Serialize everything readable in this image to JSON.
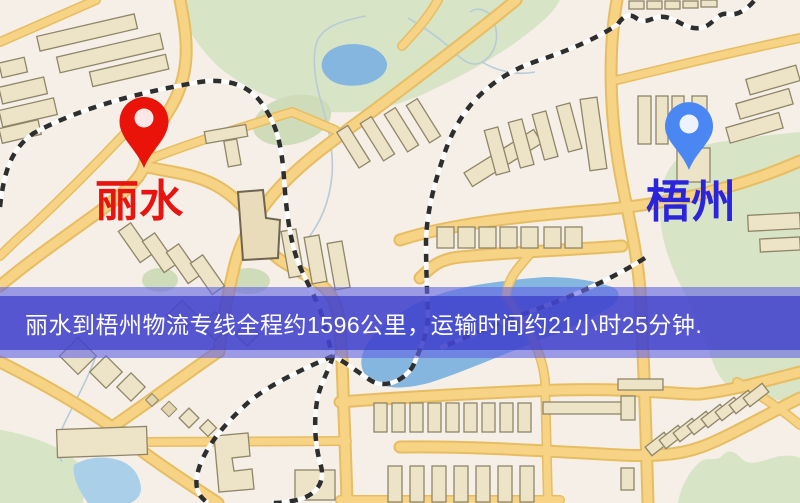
{
  "banner": {
    "text": "丽水到梧州物流专线全程约1596公里，运输时间约21小时25分钟.",
    "text_color": "#ffffff",
    "inner_band_color": "rgba(58,60,200,0.72)",
    "outer_band_color": "rgba(100,102,228,0.62)"
  },
  "route": {
    "origin": "丽水",
    "destination": "梧州",
    "distance_km": "1596",
    "duration": "21小时25分钟"
  },
  "markers": {
    "origin": {
      "label": "丽水",
      "pin_color": "#ea1309",
      "label_color": "#e71410",
      "icon": "map-pin-icon"
    },
    "destination": {
      "label": "梧州",
      "pin_color": "#4b87f2",
      "label_color": "#2a24dd",
      "icon": "map-pin-icon"
    }
  },
  "map_colors": {
    "background": "#f5efe7",
    "road_fill": "#f6d385",
    "road_casing": "#e7bd62",
    "park_green": "#d7e4c6",
    "water_blue": "#84b6e0",
    "building_fill": "#ede3c6",
    "building_outline": "#8f8569",
    "railway_dark": "#2e2e2e"
  }
}
